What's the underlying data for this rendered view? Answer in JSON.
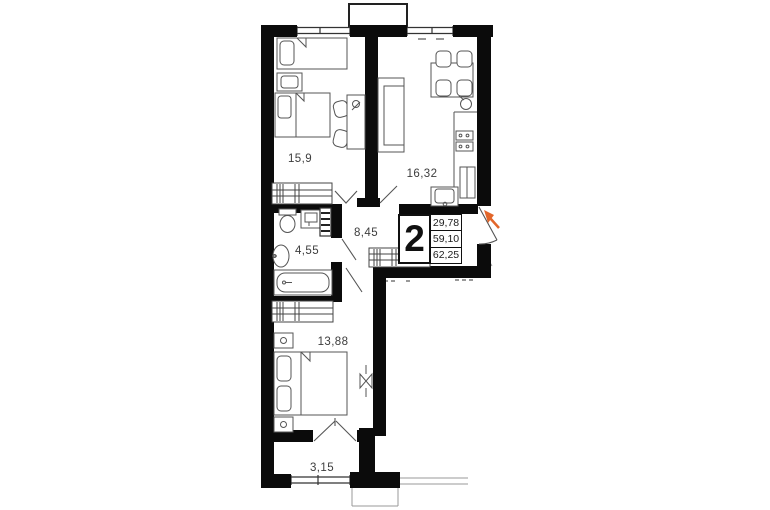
{
  "plan_card": {
    "rooms_count": "2",
    "area_rows": [
      "29,78",
      "59,10",
      "62,25"
    ]
  },
  "room_areas": {
    "bedroom_1": "15,9",
    "kitchen_living_room": "16,32",
    "hallway": "8,45",
    "bathroom": "4,55",
    "bedroom_2": "13,88",
    "balcony": "3,15"
  },
  "colors": {
    "walls": "#0b0b0b",
    "furniture_lines": "#555555",
    "label_text": "#3d3d3d",
    "entrance_arrow": "#e2662a",
    "background": "#ffffff"
  }
}
